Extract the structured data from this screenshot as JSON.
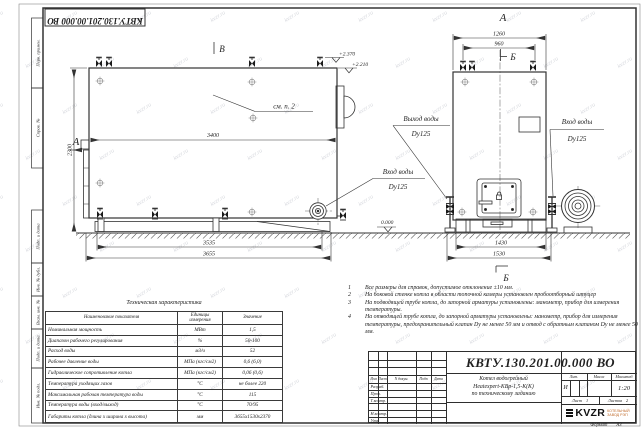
{
  "watermark": {
    "text": "kvzr.ru"
  },
  "frame": {
    "doc_number_top": "КВТУ.130.201.00.000 ВО",
    "margin_labels": [
      "Перв. примен.",
      "Справ. №",
      "Подп. и дата",
      "Инв. № дубл.",
      "Взам. инв. №",
      "Подп. и дата",
      "Инв. № подл."
    ]
  },
  "side": {
    "view_arrow": "А",
    "top_mark": "В",
    "see_note": "см. п. 2",
    "elev1": "+2.370",
    "elev2": "+2.210",
    "dim_width": "3400",
    "dim_height": "2300",
    "dim_base1": "3535",
    "dim_base2": "3655",
    "inlet": {
      "line1": "Вход воды",
      "line2": "Dy125"
    }
  },
  "front": {
    "title": "А",
    "section_mark": "Б",
    "dim_top1": "1260",
    "dim_top2": "960",
    "dim_base1": "1430",
    "dim_base2": "1530",
    "elev_zero": "0.000",
    "outlet": {
      "line1": "Выход воды",
      "line2": "Dy125"
    },
    "inlet": {
      "line1": "Вход воды",
      "line2": "Dy125"
    }
  },
  "notes": [
    {
      "num": "1",
      "text": "Все размеры для справок, допустимое отклонение ±10 мм."
    },
    {
      "num": "2",
      "text": "На боковой стенке котла в области топочной камеры установлен пробоотборный штуцер"
    },
    {
      "num": "3",
      "text": "На подводящей трубе котла, до запорной арматуры установлены: манометр, прибор для измерения температуры."
    },
    {
      "num": "4",
      "text": "На отводящей трубе котла, до запорной арматуры установлены: манометр, прибор для измерения температуры, предохранительный клапан Dу не менее 50 мм и отвод с обратным клапаном Dу не менее 50 мм."
    }
  ],
  "tech_table": {
    "title": "Техническая характеристика",
    "headers": [
      "Наименование показателя",
      "Единицы измерения",
      "Значение"
    ],
    "rows": [
      {
        "name": "Номинальная мощность",
        "unit": "МВт",
        "value": "1,5"
      },
      {
        "name": "Диапазон рабочего регулирования",
        "unit": "%",
        "value": "50-100"
      },
      {
        "name": "Расход воды",
        "unit": "м3/ч",
        "value": "52"
      },
      {
        "name": "Рабочее давление воды",
        "unit": "МПа (кгс/см2)",
        "value": "0,6 (6,0)"
      },
      {
        "name": "Гидравлическое сопротивление котла",
        "unit": "МПа (кгс/см2)",
        "value": "0,06 (0,6)"
      },
      {
        "name": "Температура уходящих газов",
        "unit": "°С",
        "value": "не более 220"
      },
      {
        "name": "Максимальная рабочая температура воды",
        "unit": "°С",
        "value": "115"
      },
      {
        "name": "Температура воды (вход/выход)",
        "unit": "°С",
        "value": "70/95"
      },
      {
        "name": "Габариты котла (длина х ширина х высота)",
        "unit": "мм",
        "value": "3655х1530х2370"
      }
    ]
  },
  "title_block": {
    "doc_number": "КВТУ.130.201.00.000  ВО",
    "name_lines": [
      "Котел водогрейный",
      "Heatexpert-КВр-1,5-К(К)",
      "по техническому заданию"
    ],
    "header_cells": [
      "Изм",
      "Лист",
      "N докум.",
      "Подп",
      "Дата"
    ],
    "row_labels": [
      "Разраб.",
      "Пров.",
      "Т.контр.",
      "Н.контр.",
      "Утв."
    ],
    "lit_header": "Лит.",
    "mass_header": "Масса",
    "scale_header": "Масштаб",
    "lit_value": "И",
    "scale_value": "1:20",
    "sheet_label": "Лист",
    "sheet_value": "1",
    "sheets_label": "Листов",
    "sheets_value": "2",
    "logo_text": "KVZR",
    "logo_sub1": "КОТЕЛЬНЫЙ",
    "logo_sub2": "ЗАВОД РЭП"
  },
  "format": {
    "label": "Формат",
    "value": "А3"
  }
}
